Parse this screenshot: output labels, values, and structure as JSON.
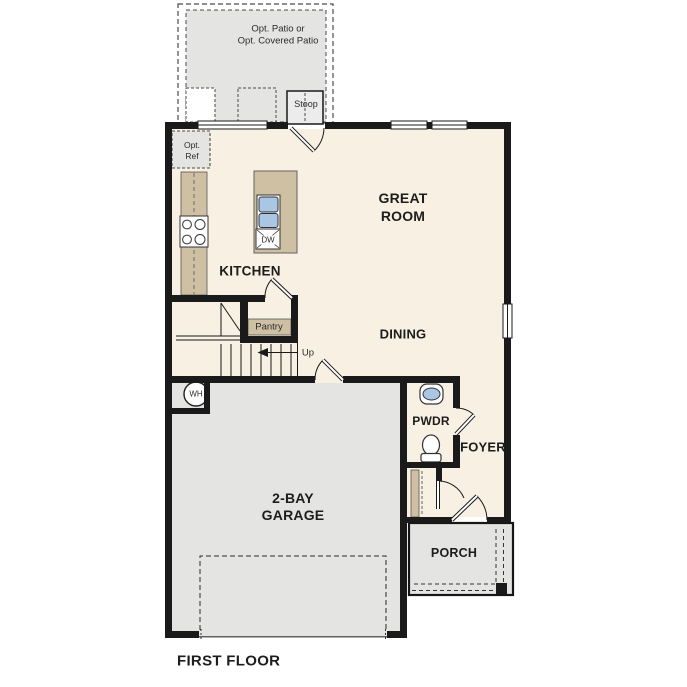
{
  "plan": {
    "title": "FIRST FLOOR",
    "rooms": {
      "great_room": {
        "name_line1": "GREAT",
        "name_line2": "ROOM"
      },
      "kitchen": {
        "name": "KITCHEN"
      },
      "dining": {
        "name": "DINING"
      },
      "garage": {
        "name_line1": "2-BAY",
        "name_line2": "GARAGE"
      },
      "powder": {
        "name": "PWDR"
      },
      "foyer": {
        "name": "FOYER"
      },
      "porch": {
        "name": "PORCH"
      },
      "pantry": {
        "name": "Pantry"
      }
    },
    "features": {
      "opt_patio_line1": "Opt. Patio or",
      "opt_patio_line2": "Opt. Covered Patio",
      "stoop": "Stoop",
      "opt_ref_line1": "Opt.",
      "opt_ref_line2": "Ref",
      "stairs_direction": "Up",
      "water_heater": "WH",
      "dishwasher": "DW"
    },
    "colors": {
      "wall": "#1a1a1a",
      "interior_floor": "#f8f0e2",
      "garage_floor": "#e4e4e3",
      "counter_tan": "#cfc0a4",
      "fixture_blue": "#a9c7e4"
    }
  }
}
